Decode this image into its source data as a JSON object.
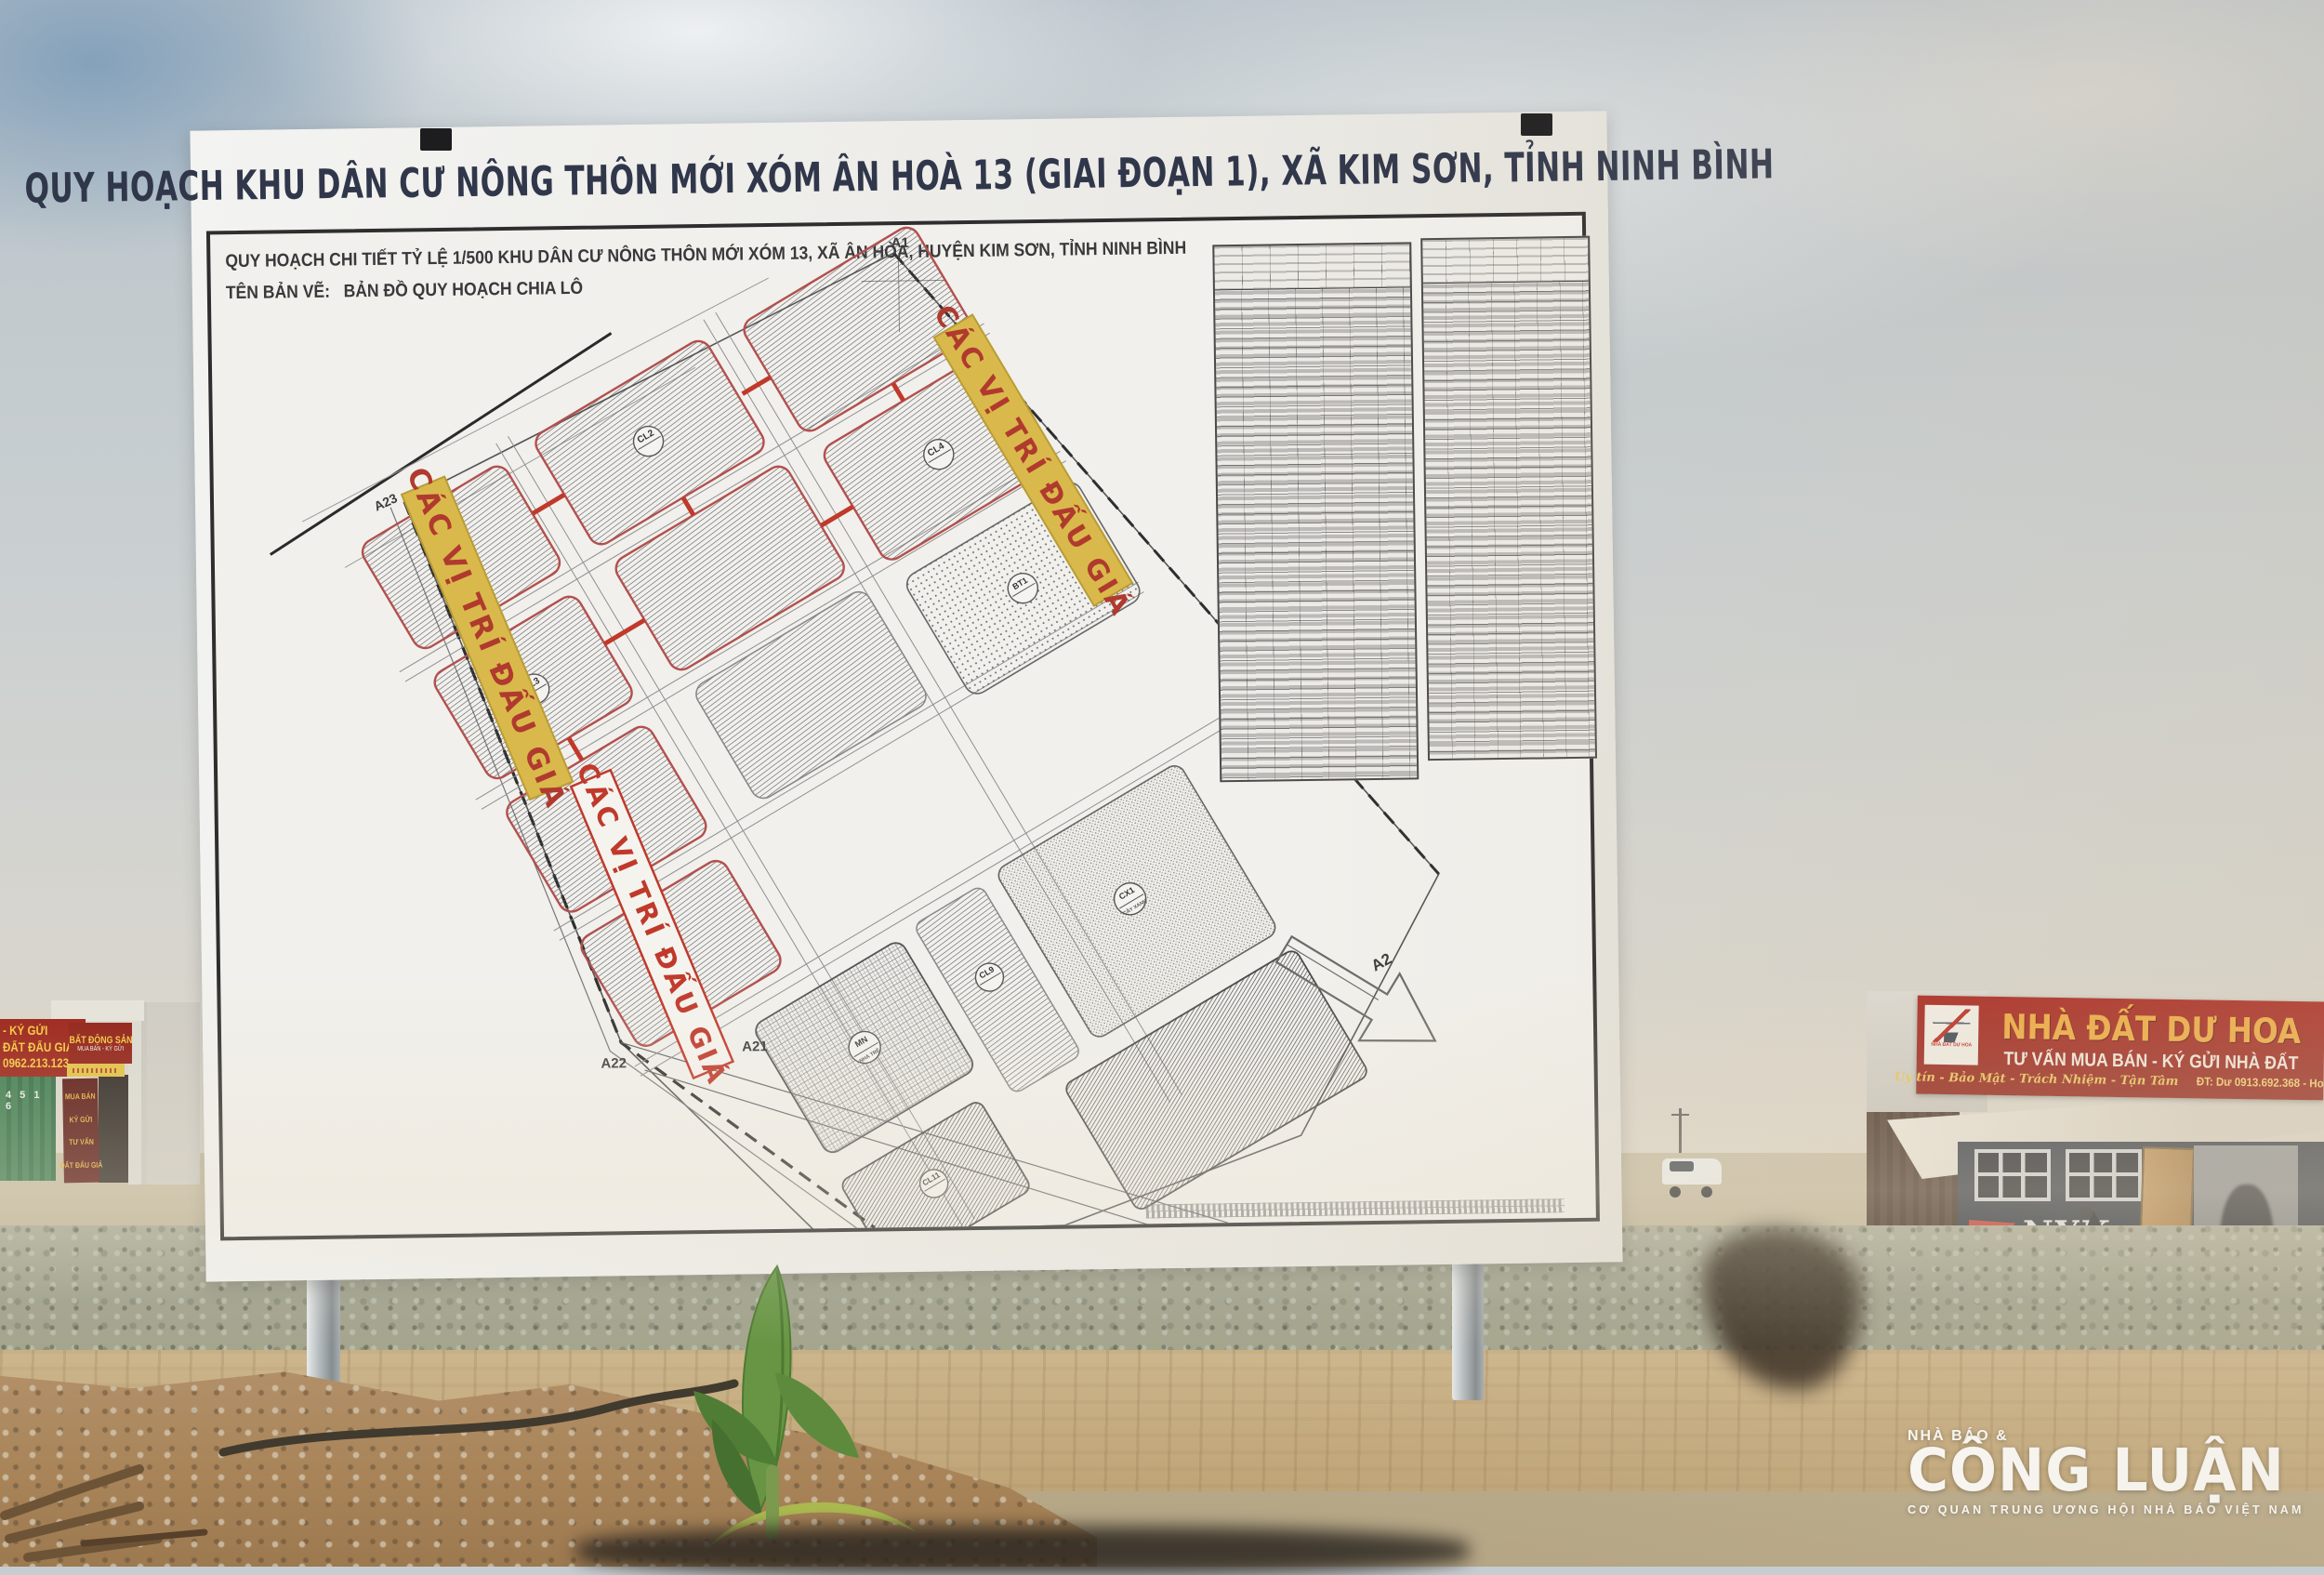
{
  "billboard": {
    "title": "QUY HOẠCH KHU DÂN CƯ NÔNG THÔN MỚI XÓM ÂN HOÀ 13 (GIAI ĐOẠN 1), XÃ KIM SƠN, TỈNH NINH BÌNH",
    "sheet": {
      "line1": "QUY HOẠCH CHI TIẾT TỶ LỆ 1/500 KHU DÂN CƯ NÔNG THÔN MỚI XÓM 13, XÃ ÂN HÒA, HUYỆN KIM SƠN, TỈNH NINH BÌNH",
      "drawing_label": "TÊN BẢN VẼ:",
      "drawing_name": "BẢN ĐỒ QUY HOẠCH CHIA LÔ"
    },
    "map": {
      "auction_label": "CÁC VỊ TRÍ ĐẤU GIÁ",
      "markers": {
        "a1": "A1",
        "a2": "A2",
        "a21": "A21",
        "a22": "A22",
        "a23": "A23"
      },
      "blocks": {
        "cl1": "CL1",
        "cl2": "CL2",
        "cl3": "CL3",
        "cl4": "CL4",
        "cl9": "CL9",
        "cl11": "CL11",
        "bt1": "BT1",
        "mn": "MN",
        "cx1": "CX1"
      },
      "block_sublabels": {
        "cx1": "CÂY XANH",
        "mn": "NHÀ TRẺ"
      }
    },
    "colors": {
      "auction_strip": "#d9b94b",
      "auction_text": "#b03a2e",
      "block_border": "#b2504e"
    }
  },
  "left_signs": {
    "sign1_lines": {
      "l1": "- KÝ GỬI",
      "l2": "ĐẤT ĐẤU GIÁ",
      "l3": "0962.213.123"
    },
    "sign2_title": "BẤT ĐỘNG SẢN",
    "sign2_sub": "MUA BÁN - KÝ GỬI",
    "banner_lines": {
      "w1": "MUA BÁN",
      "w2": "KÝ GỬI",
      "w3": "TƯ VẤN",
      "w4": "ĐẤT ĐẤU GIÁ"
    },
    "container_marking": "4 5 1 6"
  },
  "shop": {
    "logo_caption": "NHÀ ĐẤT DƯ HOA",
    "title": "NHÀ ĐẤT DƯ HOA",
    "line2": "TƯ VẤN MUA BÁN - KÝ GỬI NHÀ ĐẤT",
    "line3_script": "Uy tín - Bảo Mật - Trách Nhiệm - Tận Tâm",
    "line3_phone": "ĐT: Dư 0913.692.368 - Hoa 0973.692.256",
    "colors": {
      "bg": "#a8211a",
      "title": "#f0a838",
      "line2": "#f3ece0",
      "line3": "#e9c452"
    }
  },
  "nyk": {
    "brand": "NYK",
    "brand_suffix": "LINE"
  },
  "watermark": {
    "top": "NHÀ BÁO &",
    "main": "CÔNG LUẬN",
    "sub": "CƠ QUAN TRUNG ƯƠNG HỘI NHÀ BÁO VIỆT NAM"
  }
}
